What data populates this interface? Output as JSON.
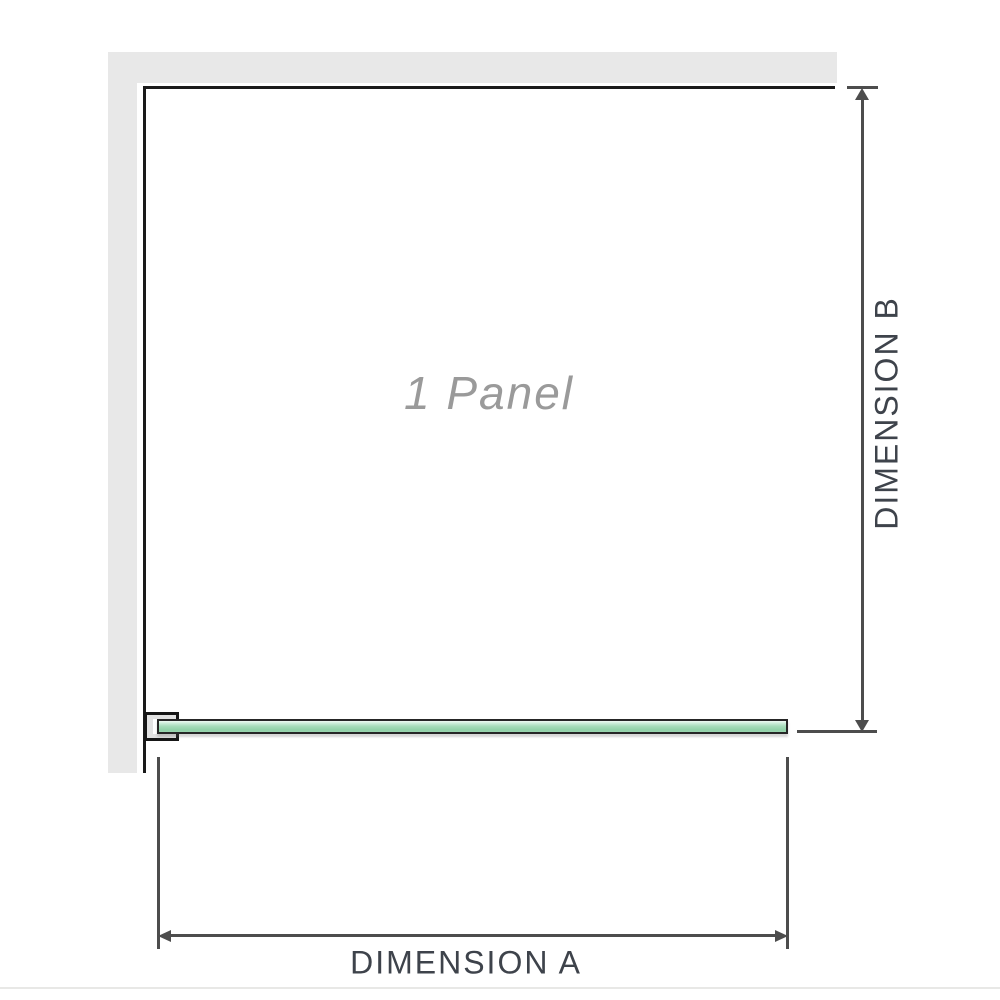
{
  "diagram": {
    "panel_label": "1 Panel",
    "dimension_a_label": "DIMENSION A",
    "dimension_b_label": "DIMENSION B"
  },
  "colors": {
    "wall": "#e8e8e8",
    "panel_outline": "#1a1a1a",
    "glass_green": "#a6dcba",
    "glass_border": "#262626",
    "dimension_line": "#4d4d4d",
    "dimension_text": "#3e434b",
    "panel_label_text": "#9a9a9a"
  }
}
